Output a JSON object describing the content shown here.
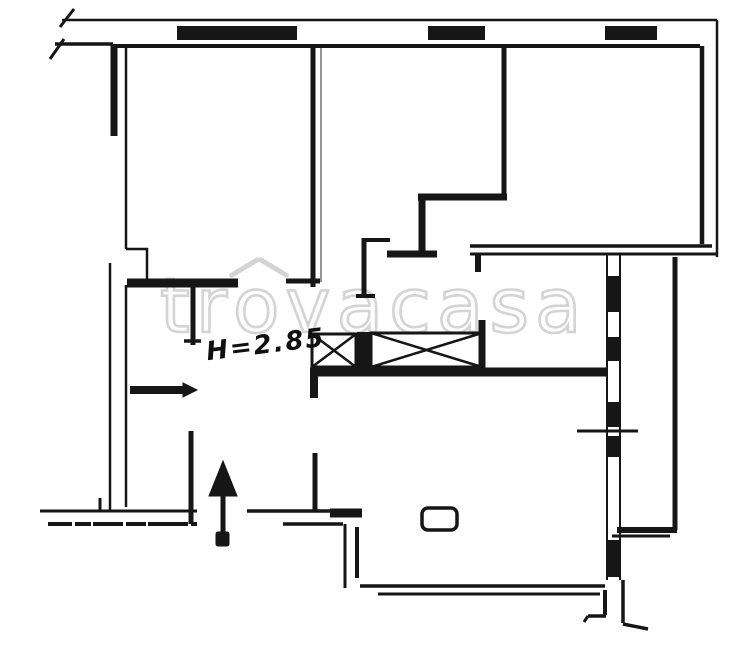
{
  "plan": {
    "watermark": {
      "full_text": "trovacasa",
      "prefix": "tr",
      "o": "o",
      "suffix": "vacasa"
    },
    "annotation": {
      "ceiling_height": "H=2.85"
    },
    "colors": {
      "ink": "#161616",
      "watermark": "#d4d4d4",
      "background": "#ffffff"
    }
  }
}
